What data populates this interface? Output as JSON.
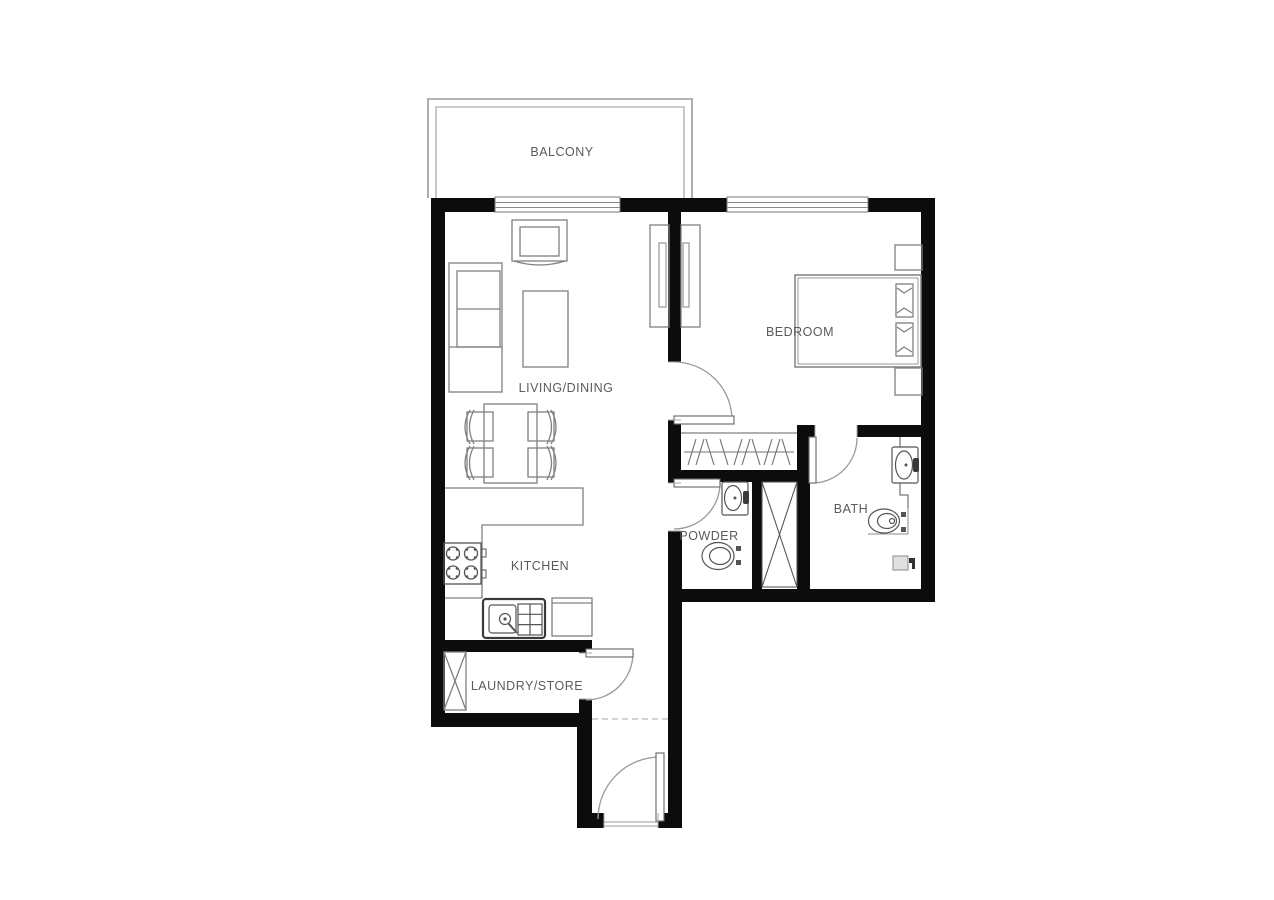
{
  "colors": {
    "background": "#ffffff",
    "wall": "#0c0c0c",
    "furniture_line": "#808080",
    "fixture_line": "#555555",
    "door_arc": "#999999",
    "label_text": "#5b5b5b",
    "drain_fill": "#e0e0e0"
  },
  "rooms": {
    "balcony": "BALCONY",
    "living_dining": "LIVING/DINING",
    "bedroom": "BEDROOM",
    "kitchen": "KITCHEN",
    "powder": "POWDER",
    "bath": "BATH",
    "laundry_store": "LAUNDRY/STORE"
  },
  "fixtures": [
    "sofa",
    "armchair",
    "coffee-table",
    "tv-unit",
    "dining-table",
    "dining-chairs",
    "kitchen-counter",
    "stove",
    "kitchen-sink",
    "refrigerator",
    "washing-machine",
    "wardrobe",
    "closet-hanging-rail",
    "bed",
    "pillows",
    "nightstands",
    "vanity-sink",
    "toilet",
    "duct-shaft",
    "floor-drain",
    "doors",
    "windows"
  ]
}
